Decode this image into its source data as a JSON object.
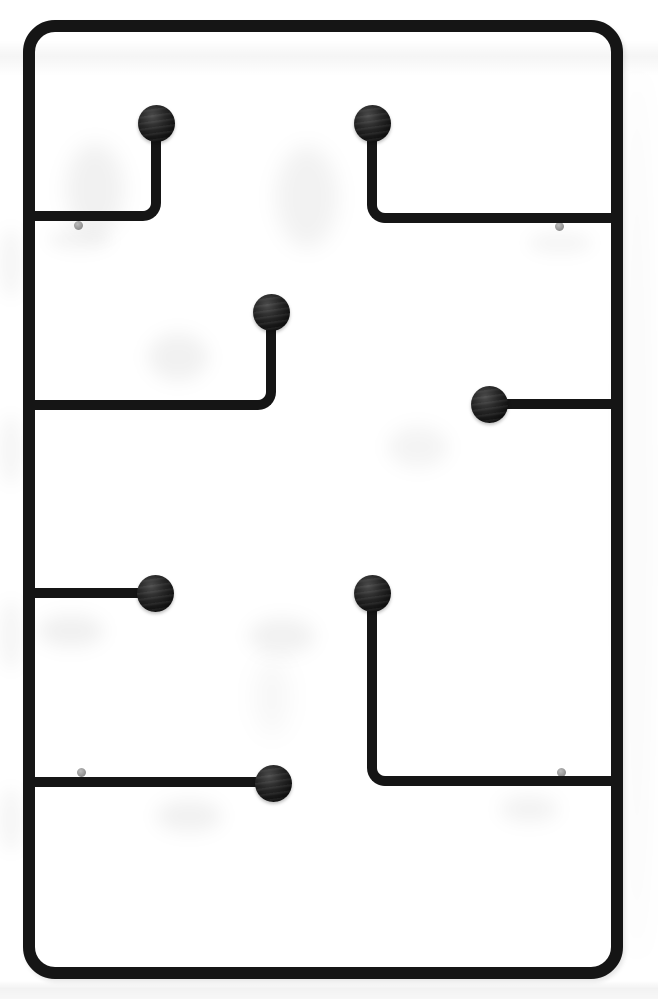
{
  "scene": {
    "description": "Product photo of a black metal wall-mounted coat rack: rounded rectangular wire frame with seven ball-tipped hooks on white wall",
    "background_color": "#ffffff",
    "wire_color": "#151515",
    "ball_color": "#1c1c1c",
    "anchor_dot_color": "#8d8d8d",
    "shadow_color": "#000000"
  },
  "frame": {
    "left": 23,
    "top": 20,
    "width": 600,
    "height": 959,
    "thickness": 12,
    "corner_radius": 32
  },
  "wire_thickness": 10,
  "ball_diameter": 37,
  "anchor_dot_diameter": 9,
  "hooks": [
    {
      "id": "top-left",
      "type": "elbow",
      "corner": "br",
      "left": 30,
      "top": 120,
      "width": 131,
      "height": 101,
      "ball": {
        "left": 138,
        "top": 105
      }
    },
    {
      "id": "top-right",
      "type": "elbow",
      "corner": "bl",
      "left": 367,
      "top": 120,
      "width": 251,
      "height": 103,
      "ball": {
        "left": 354,
        "top": 105
      }
    },
    {
      "id": "middle-left",
      "type": "elbow",
      "corner": "br",
      "left": 30,
      "top": 310,
      "width": 246,
      "height": 100,
      "ball": {
        "left": 253,
        "top": 294
      }
    },
    {
      "id": "middle-right",
      "type": "straight",
      "left": 480,
      "top": 399,
      "width": 138,
      "ball": {
        "left": 471,
        "top": 386
      }
    },
    {
      "id": "lower-left",
      "type": "straight",
      "left": 30,
      "top": 588,
      "width": 135,
      "ball": {
        "left": 137,
        "top": 575
      }
    },
    {
      "id": "lower-right",
      "type": "elbow",
      "corner": "bl",
      "left": 367,
      "top": 590,
      "width": 251,
      "height": 196,
      "ball": {
        "left": 354,
        "top": 575
      }
    },
    {
      "id": "bottom-left",
      "type": "straight",
      "left": 30,
      "top": 777,
      "width": 248,
      "ball": {
        "left": 255,
        "top": 765
      }
    }
  ],
  "anchor_dots": [
    {
      "left": 74,
      "top": 221
    },
    {
      "left": 555,
      "top": 222
    },
    {
      "left": 77,
      "top": 768
    },
    {
      "left": 557,
      "top": 768
    }
  ],
  "shadows": [
    {
      "left": 66,
      "top": 143,
      "width": 58,
      "height": 92,
      "blur": 10,
      "alpha": 0.055
    },
    {
      "left": 276,
      "top": 146,
      "width": 62,
      "height": 102,
      "blur": 10,
      "alpha": 0.05
    },
    {
      "left": 148,
      "top": 333,
      "width": 60,
      "height": 48,
      "blur": 9,
      "alpha": 0.055
    },
    {
      "left": 388,
      "top": 426,
      "width": 60,
      "height": 42,
      "blur": 9,
      "alpha": 0.045
    },
    {
      "left": 38,
      "top": 615,
      "width": 66,
      "height": 32,
      "blur": 9,
      "alpha": 0.06
    },
    {
      "left": 249,
      "top": 618,
      "width": 66,
      "height": 36,
      "blur": 9,
      "alpha": 0.055
    },
    {
      "left": 255,
      "top": 658,
      "width": 34,
      "height": 78,
      "blur": 12,
      "alpha": 0.03
    },
    {
      "left": 156,
      "top": 800,
      "width": 66,
      "height": 32,
      "blur": 9,
      "alpha": 0.055
    },
    {
      "left": 500,
      "top": 796,
      "width": 58,
      "height": 26,
      "blur": 9,
      "alpha": 0.05
    },
    {
      "left": 48,
      "top": 228,
      "width": 64,
      "height": 22,
      "blur": 8,
      "alpha": 0.045
    },
    {
      "left": 528,
      "top": 232,
      "width": 64,
      "height": 22,
      "blur": 8,
      "alpha": 0.04
    },
    {
      "left": 0,
      "top": 228,
      "width": 22,
      "height": 70,
      "blur": 8,
      "alpha": 0.04
    },
    {
      "left": 0,
      "top": 415,
      "width": 22,
      "height": 70,
      "blur": 8,
      "alpha": 0.04
    },
    {
      "left": 0,
      "top": 600,
      "width": 22,
      "height": 70,
      "blur": 8,
      "alpha": 0.04
    },
    {
      "left": 0,
      "top": 788,
      "width": 22,
      "height": 64,
      "blur": 8,
      "alpha": 0.04
    },
    {
      "left": 624,
      "top": 70,
      "width": 26,
      "height": 890,
      "blur": 12,
      "alpha": 0.025
    }
  ],
  "bands": {
    "top": {
      "top": 40,
      "height": 36,
      "alpha": 0.04
    },
    "bottom": {
      "top": 981,
      "height": 18,
      "alpha": 0.05
    }
  }
}
